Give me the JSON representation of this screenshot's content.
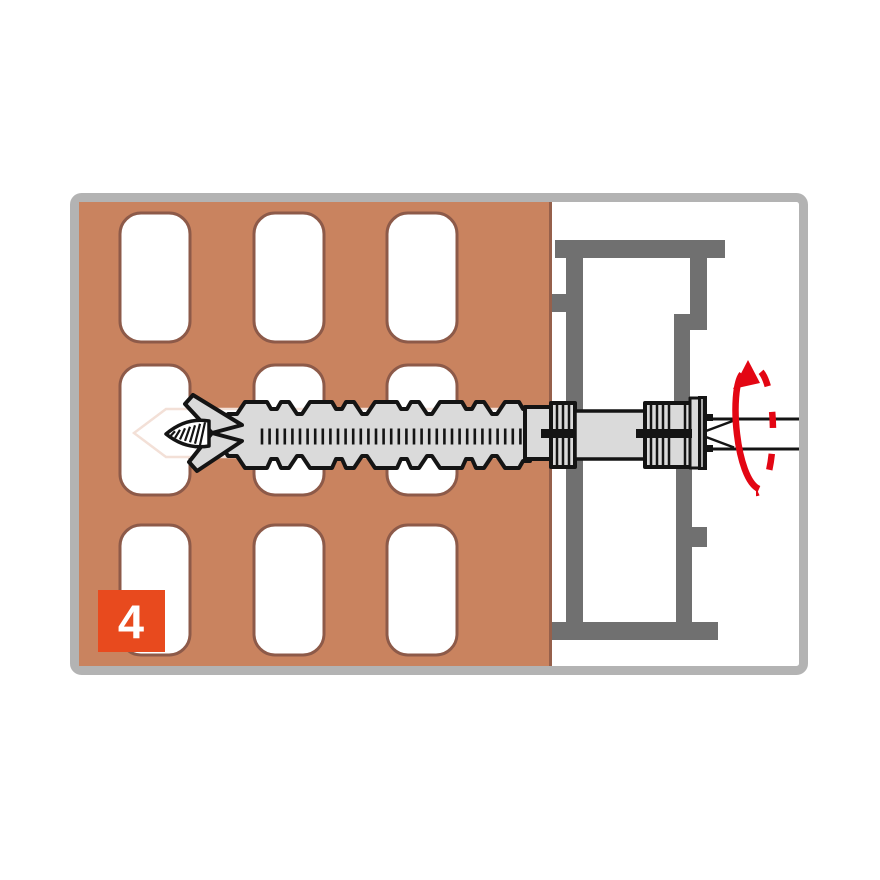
{
  "figure": {
    "title": "frame-fixing-installation-step",
    "step_badge": {
      "label": "4"
    },
    "brick_grid": {
      "rows": 3,
      "columns": 3
    },
    "parts": [
      "brick-wall",
      "brick-perforation-hole",
      "drill-channel",
      "window-frame-profile",
      "fixing-sleeve",
      "screw",
      "rotation-arrow",
      "step-badge"
    ],
    "colors": {
      "background": "#ffffff",
      "frame_border": "#b3b3b3",
      "brick": "#c9835f",
      "brick_edge": "#96604b",
      "hole_fill": "#ffffff",
      "hole_border": "#8d5a49",
      "profile": "#707070",
      "anchor_fill": "#dadada",
      "outline": "#141414",
      "channel_outline": "#f3e0d7",
      "arrow_red": "#e30613",
      "badge_bg": "#e84a1e",
      "badge_text": "#ffffff"
    }
  }
}
